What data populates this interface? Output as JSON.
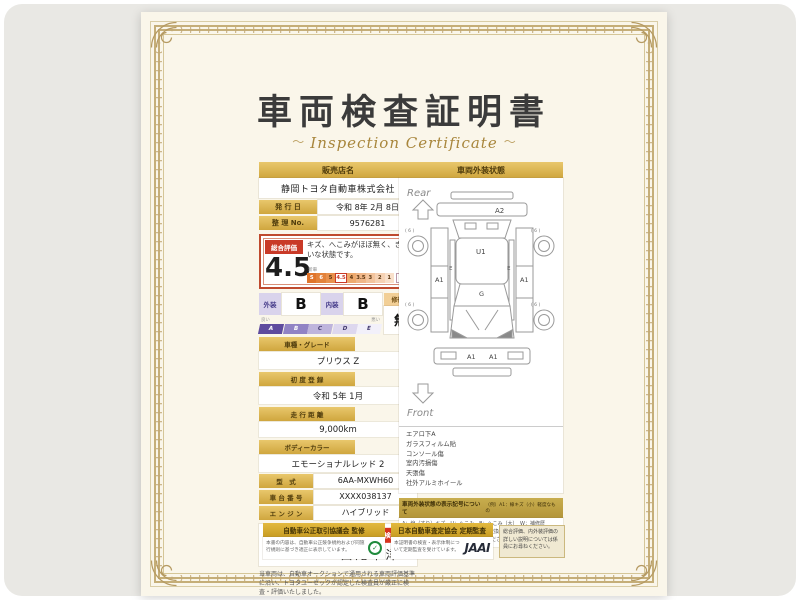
{
  "page": {
    "title_jp": "車両検査証明書",
    "title_en": "Inspection Certificate",
    "ornament": "～"
  },
  "dealer": {
    "header": "販売店名",
    "name": "静岡トヨタ自動車株式会社",
    "issue_label": "発 行 日",
    "issue_value": "令和 8年 2月 8日",
    "ref_label": "整 理 No.",
    "ref_value": "9576281"
  },
  "rating": {
    "header": "総合評価",
    "score": "4.5",
    "comment": "キズ、へこみがほぼ無く、きれいな状態です。",
    "scale_left": "新車",
    "scale_right": "低",
    "cells": [
      "S",
      "6",
      "5",
      "4.5",
      "4",
      "3.5",
      "3",
      "2",
      "1"
    ],
    "highlight": "4.5",
    "judge": "判定"
  },
  "grades": {
    "ext_label": "外装",
    "ext": "B",
    "int_label": "内装",
    "int": "B",
    "repair_label": "修復歴",
    "repair": "無",
    "good": "良い",
    "bad": "悪い",
    "cells": [
      "A",
      "B",
      "C",
      "D",
      "E"
    ]
  },
  "specs": {
    "stacked": [
      {
        "label": "車種・グレード",
        "value": "プリウス Z"
      },
      {
        "label": "初 度 登 録",
        "value": "令和 5年 1月"
      },
      {
        "label": "走 行 距 離",
        "value": "9,000km"
      },
      {
        "label": "ボディーカラー",
        "value": "エモーショナルレッド 2"
      }
    ],
    "inline": [
      {
        "label": "型　式",
        "value": "6AA-MXWH60"
      },
      {
        "label": "車 台 番 号",
        "value": "XXXX038137"
      },
      {
        "label": "エ ン ジ ン",
        "value": "ハイブリッド"
      }
    ]
  },
  "inspector": {
    "brand": "TOYOTA",
    "badge": "トヨタ認定車両検査員",
    "name": "西尾幸洋"
  },
  "disclaimer": "当車両は、自動車オークションで通用される車両評価基準に沿い、トヨタユーゼックが認定した検査員が厳正に検査・評価いたしました。",
  "diagram": {
    "header": "車両外装状態",
    "rear": "Rear",
    "front": "Front",
    "marks": {
      "rear_gate": "A2",
      "roof": "U1",
      "cowl": "G",
      "left_panel": "A1",
      "right_panel": "A1",
      "left_sill": "E",
      "right_sill": "E",
      "bumper_l": "A1",
      "bumper_r": "A1",
      "wheel_rl": "( 6 )",
      "wheel_rr": "( 6 )",
      "wheel_fl": "( 6 )",
      "wheel_fr": "( 6 )"
    }
  },
  "equipment": [
    "エアロ下A",
    "ガラスフィルム貼",
    "コンソール傷",
    "室内汚損傷",
    "天張傷",
    "社外アルミホイール"
  ],
  "legend": {
    "header": "車両外装状態の表示記号について",
    "example": "（例）A1：線キズ（小）軽度なもの",
    "lines": [
      "A：線（すり）キズ　U：へこみ　B：へこみ（大）　W：補修歴",
      "S：サビ　C：腐食　X：要交換　XX：交換済　Y：破れ",
      "※タイヤ・細部の状態は係員にお尋ねください。"
    ]
  },
  "footer": {
    "council_title": "自動車公正取引協議会 監修",
    "council_note": "本書の内容は、自動車公正競争規約および同施行規則に基づき適正に表示しています。",
    "jaai_title": "日本自動車査定協会 定期監査",
    "jaai_note": "本証明書の検査・表示体制について定期監査を受けています。",
    "jaai_logo": "JAAI",
    "side_note": "総合評価、内外装評価の詳しい説明については係員にお尋ねください。"
  },
  "colors": {
    "gold": "#cfa63e",
    "red": "#c93a28",
    "purple": "#5e4b9e",
    "toyota_red": "#e01f26",
    "paper": "#faf6ea"
  }
}
